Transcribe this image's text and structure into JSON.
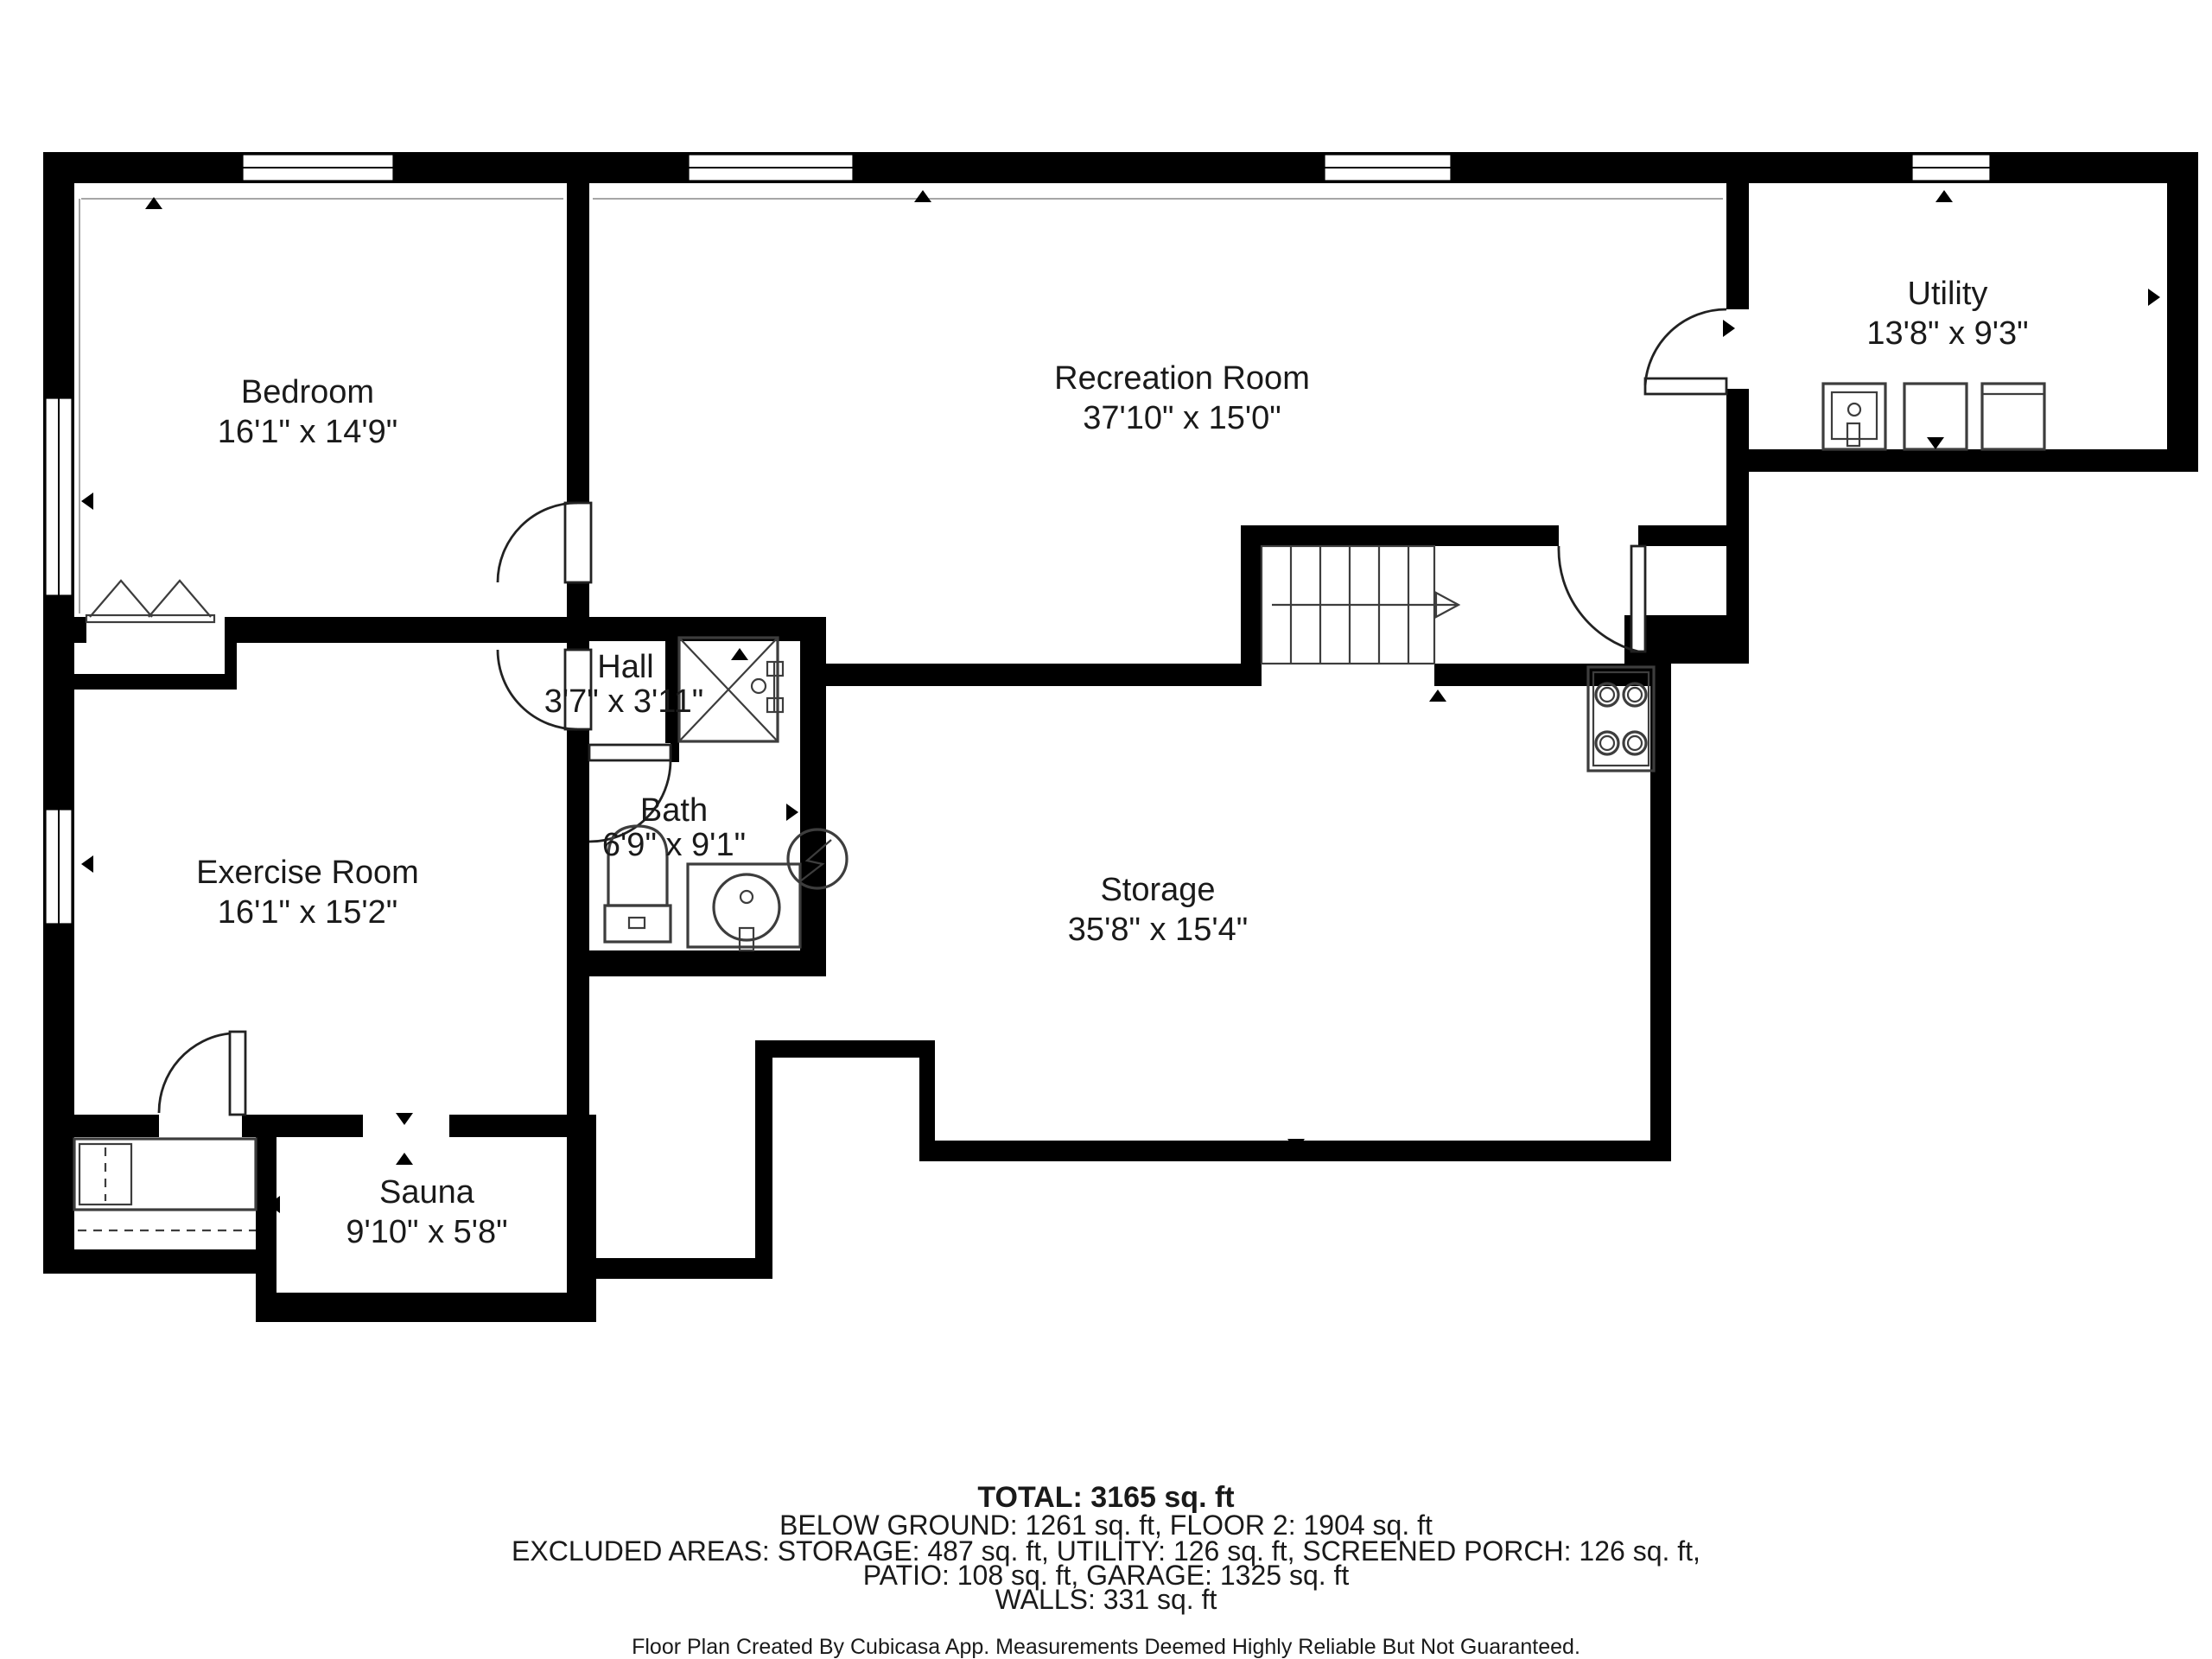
{
  "rooms": [
    {
      "name": "Bedroom",
      "dims": "16'1\" x 14'9\""
    },
    {
      "name": "Recreation Room",
      "dims": "37'10\" x 15'0\""
    },
    {
      "name": "Utility",
      "dims": "13'8\" x 9'3\""
    },
    {
      "name": "Hall",
      "dims": "3'7\" x 3'11\""
    },
    {
      "name": "Bath",
      "dims": "6'9\" x 9'1\""
    },
    {
      "name": "Exercise Room",
      "dims": "16'1\" x 15'2\""
    },
    {
      "name": "Storage",
      "dims": "35'8\" x 15'4\""
    },
    {
      "name": "Sauna",
      "dims": "9'10\" x 5'8\""
    }
  ],
  "summary": {
    "total": "TOTAL: 3165 sq. ft",
    "below_ground": "BELOW GROUND: 1261 sq. ft, FLOOR 2: 1904 sq. ft",
    "excluded": "EXCLUDED AREAS: STORAGE: 487 sq. ft, UTILITY: 126 sq. ft, SCREENED PORCH: 126 sq. ft,",
    "patio_garage": "PATIO: 108 sq. ft, GARAGE: 1325 sq. ft",
    "walls": "WALLS: 331 sq. ft",
    "disclaimer": "Floor Plan Created By Cubicasa App. Measurements Deemed Highly Reliable But Not Guaranteed."
  },
  "colors": {
    "wall": "#000000",
    "background": "#ffffff",
    "fixture": "#3d3d3d",
    "text": "#1a1a1a"
  }
}
